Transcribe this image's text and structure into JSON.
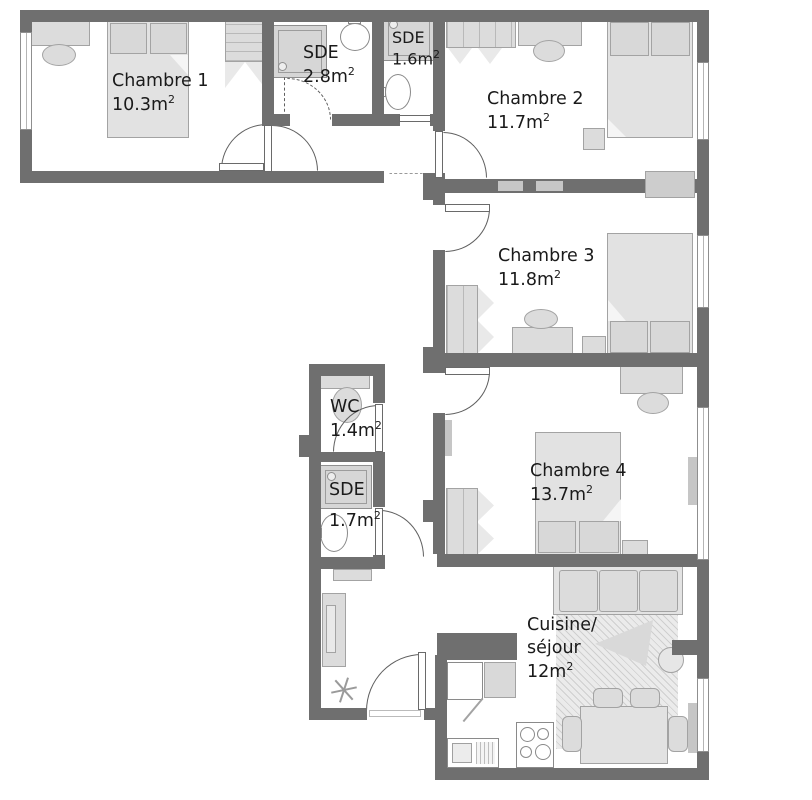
{
  "plan": {
    "colors": {
      "wall": "#6f6f6f",
      "furniture_fill": "#dcdcdc",
      "furniture_border": "#a3a3a3",
      "appliance_fill": "#ffffff",
      "text": "#1a1a1a",
      "window_border": "#8f8f8f"
    },
    "rooms": [
      {
        "id": "chambre-1",
        "label": "Chambre 1",
        "area": "10.3m",
        "sup": "2"
      },
      {
        "id": "sde-2-8",
        "label": "SDE",
        "area": "2.8m",
        "sup": "2"
      },
      {
        "id": "sde-1-6",
        "label": "SDE",
        "area": "1.6m",
        "sup": "2"
      },
      {
        "id": "chambre-2",
        "label": "Chambre 2",
        "area": "11.7m",
        "sup": "2"
      },
      {
        "id": "chambre-3",
        "label": "Chambre 3",
        "area": "11.8m",
        "sup": "2"
      },
      {
        "id": "wc",
        "label": "WC",
        "area": "1.4m",
        "sup": "2"
      },
      {
        "id": "sde-1-7",
        "label": "SDE",
        "area": "1.7m",
        "sup": "2"
      },
      {
        "id": "chambre-4",
        "label": "Chambre 4",
        "area": "13.7m",
        "sup": "2"
      },
      {
        "id": "cuisine-sejour",
        "label": "Cuisine/",
        "label2": "séjour",
        "area": "12m",
        "sup": "2"
      }
    ]
  }
}
